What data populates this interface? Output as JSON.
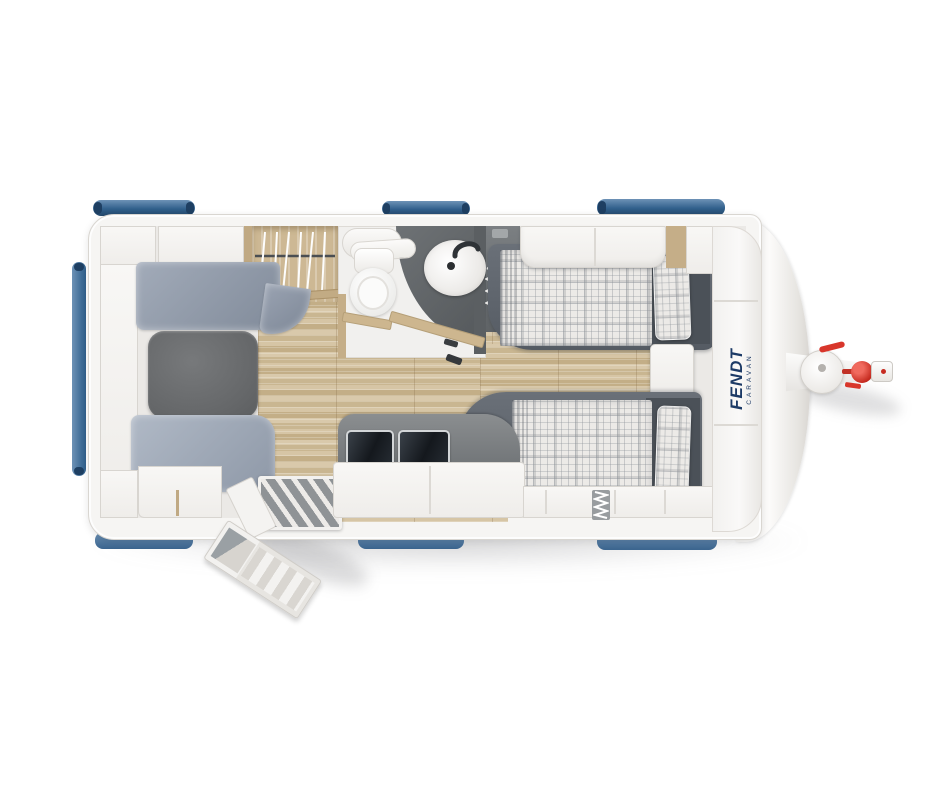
{
  "page": {
    "background": "#ffffff",
    "description": "Top-view floor plan of a Fendt caravan"
  },
  "brand": {
    "primary": "FENDT",
    "secondary": "CARAVAN",
    "text_color": "#1c3a66"
  },
  "palette": {
    "body_shell": "#f6f5f3",
    "shell_outline": "#d9d6d1",
    "interior_floor": "#ebe9e6",
    "wood_floor": "#d0bd9c",
    "upholstery_blue_gray": "#9aa4b3",
    "table_gray": "#6a6d6f",
    "bed_frame_gray": "#5b6169",
    "plaid_fabric": "#eceae7",
    "kitchen_counter": "#7d8083",
    "glass_lid": "#1d2228",
    "wood_furniture": "#c9b390",
    "bathroom_wall": "#5f6366",
    "window_blue": "#4d79a5",
    "window_blue_dark": "#24486b",
    "hitch_red": "#d8362b"
  },
  "windows": {
    "top_count": 3,
    "bottom_count": 3,
    "rear_count": 1
  },
  "features": [
    {
      "id": "dinette",
      "parts": [
        "dinette-table",
        "bench-seat-upper",
        "bench-seat-lower",
        "overhead-shelf"
      ]
    },
    {
      "id": "wardrobe",
      "parts": [
        "clothes-rail",
        "hangers"
      ]
    },
    {
      "id": "bathroom",
      "parts": [
        "toilet",
        "washbasin",
        "faucet",
        "shower-tray",
        "folding-door-open"
      ]
    },
    {
      "id": "kitchen",
      "parts": [
        "hob-glass-lid",
        "sink-glass-lid",
        "base-cabinet"
      ]
    },
    {
      "id": "twin-beds",
      "parts": [
        "bed-upper",
        "bed-lower",
        "pillow-upper",
        "pillow-lower",
        "overhead-locker",
        "nightstand"
      ]
    },
    {
      "id": "entrance",
      "parts": [
        "entry-door-open",
        "step-treads",
        "shoe-drawer-open"
      ]
    },
    {
      "id": "hitch",
      "parts": [
        "drawbar",
        "jockey-wheel-mount",
        "coupling-handle",
        "coupling-head",
        "safety-clip"
      ]
    }
  ]
}
